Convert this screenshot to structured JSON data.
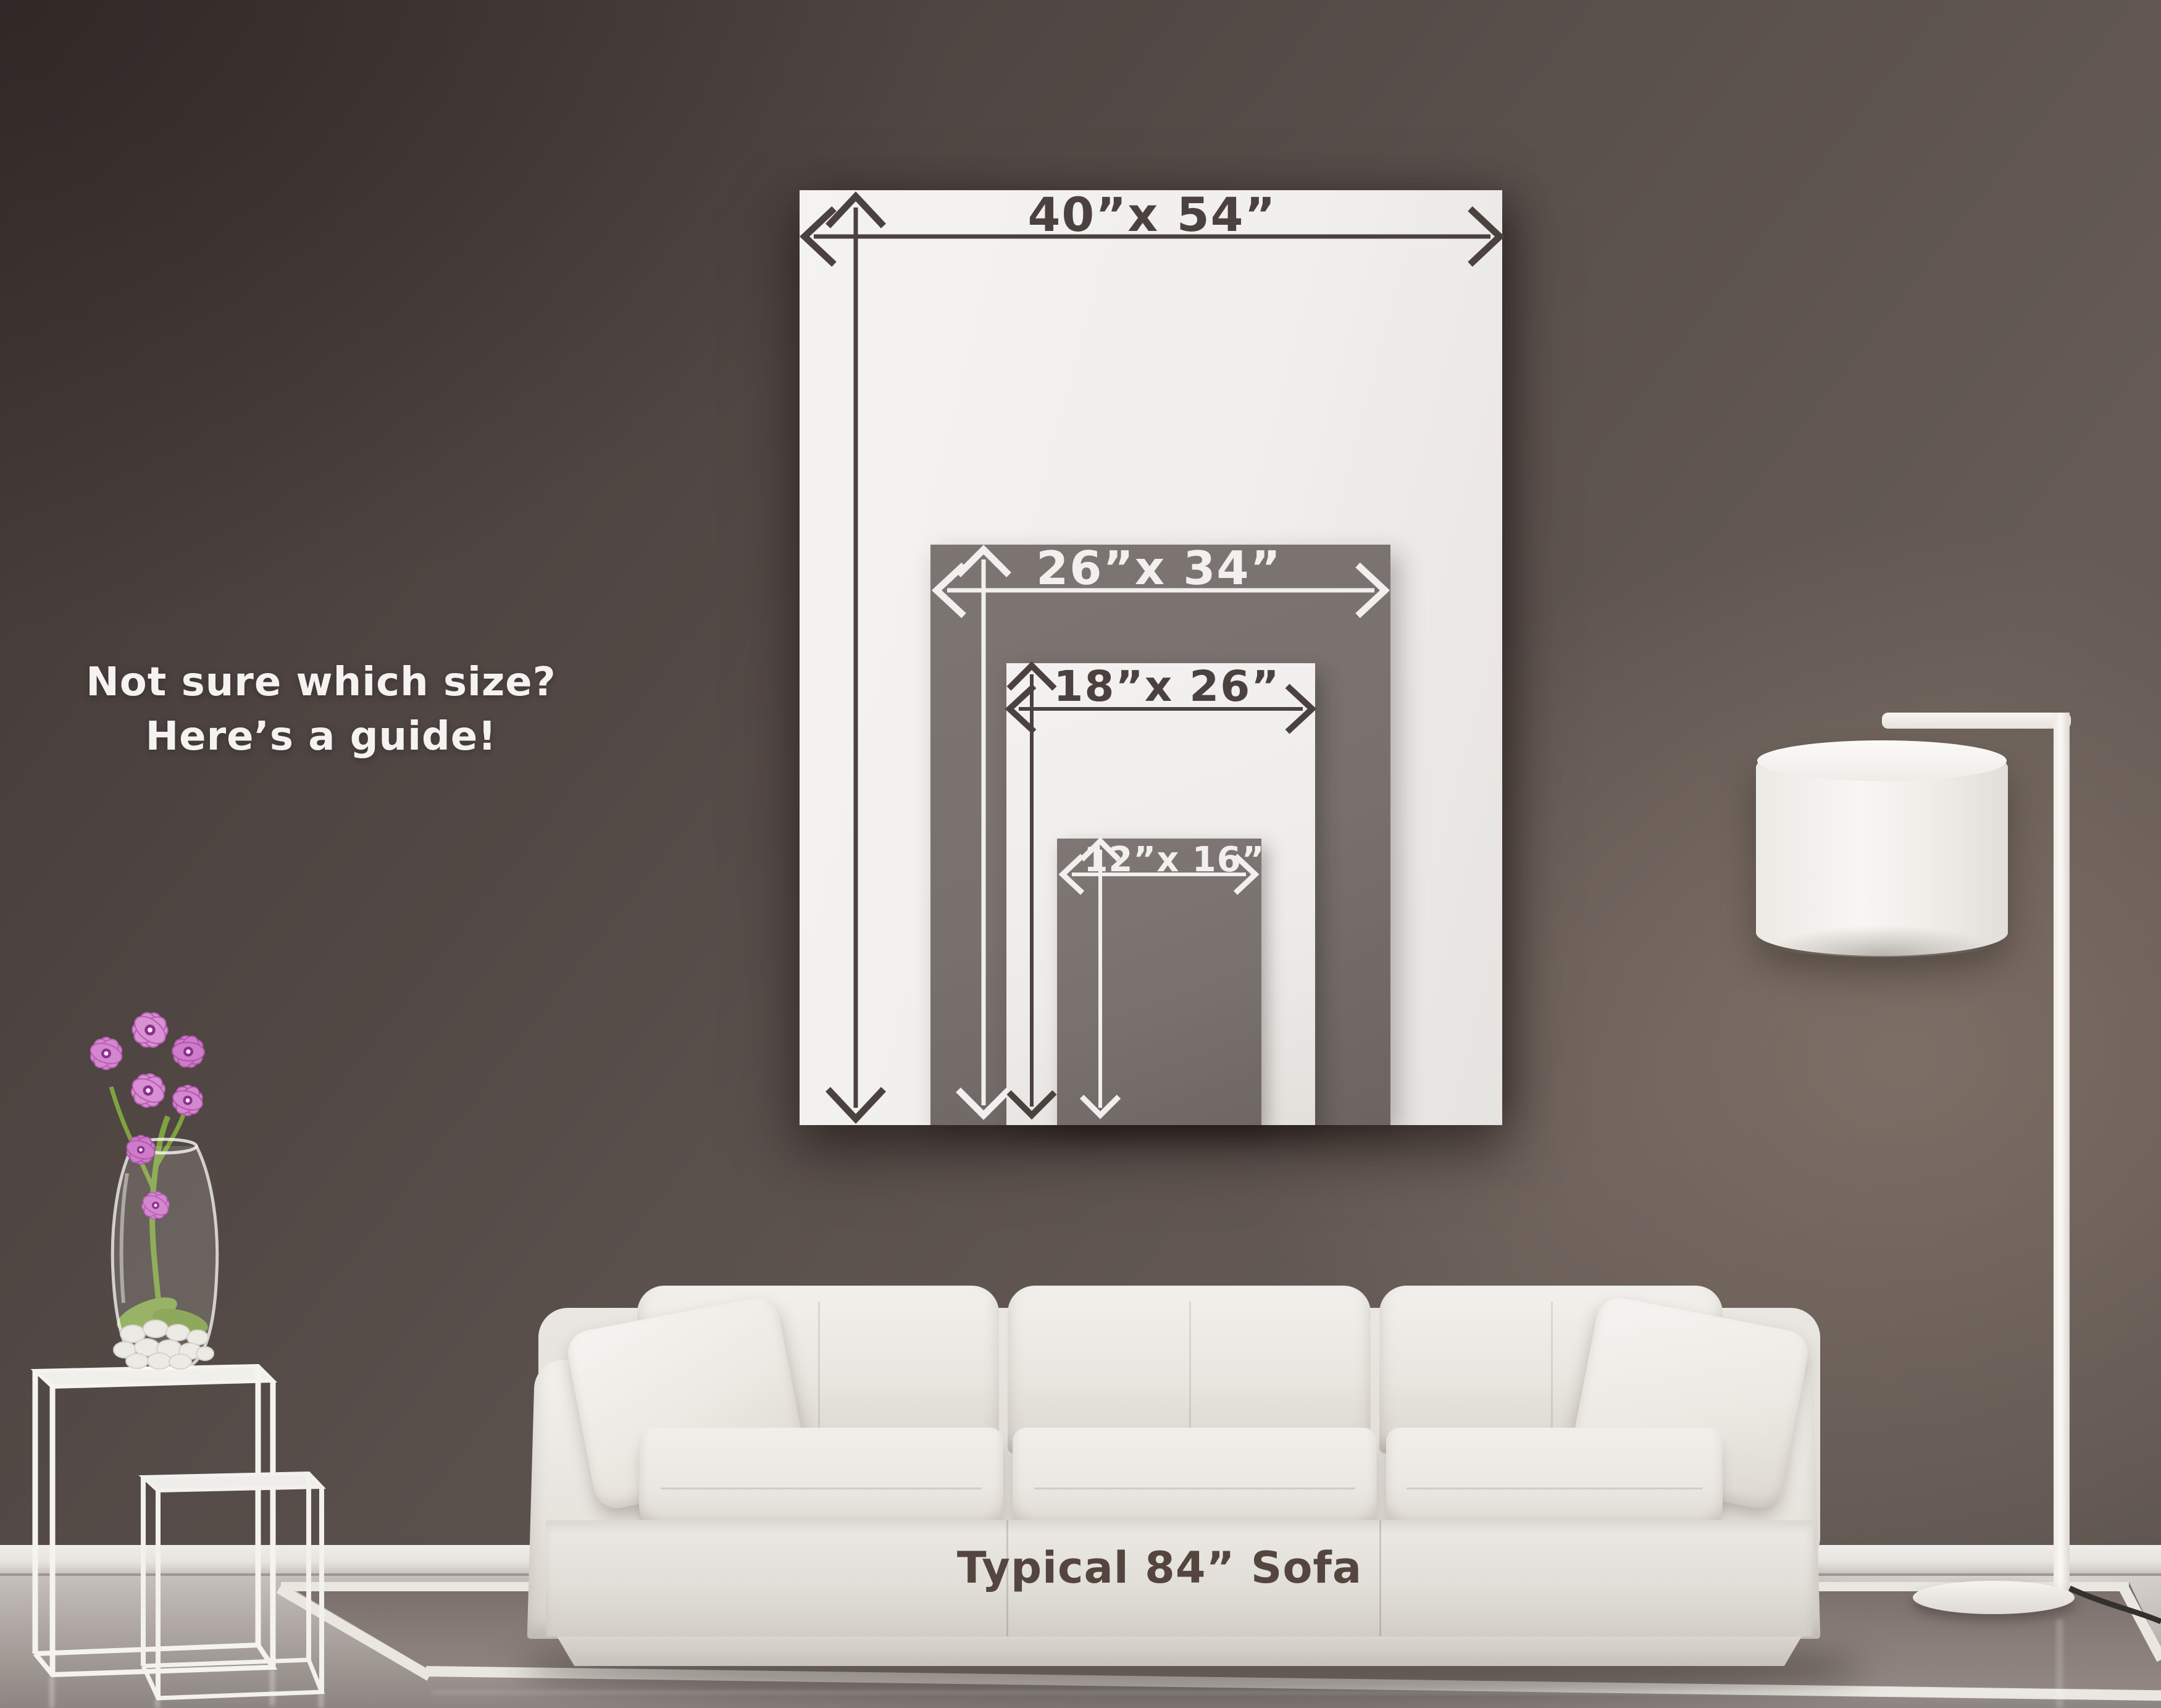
{
  "guide": {
    "heading": {
      "line1": "Not sure which size?",
      "line2": "Here’s a guide!"
    },
    "sizes": [
      {
        "id": "40x54",
        "label": "40”x 54”",
        "width_in": 40,
        "height_in": 54
      },
      {
        "id": "26x34",
        "label": "26”x 34”",
        "width_in": 26,
        "height_in": 34
      },
      {
        "id": "18x26",
        "label": "18”x 26”",
        "width_in": 18,
        "height_in": 26
      },
      {
        "id": "12x16",
        "label": "12”x 16”",
        "width_in": 12,
        "height_in": 16
      }
    ],
    "sofa_caption": "Typical 84” Sofa"
  },
  "colors": {
    "wall": "#5d534f",
    "print_gray": "#7b7370",
    "print_white": "#f3f1ef",
    "arrow_dark": "#4b4240",
    "arrow_light": "#f2f0ee",
    "heading_text": "#f5f3f1",
    "caption_text": "#54463f",
    "orchid_pink": "#d387cf",
    "stem_green": "#7ea33f"
  }
}
